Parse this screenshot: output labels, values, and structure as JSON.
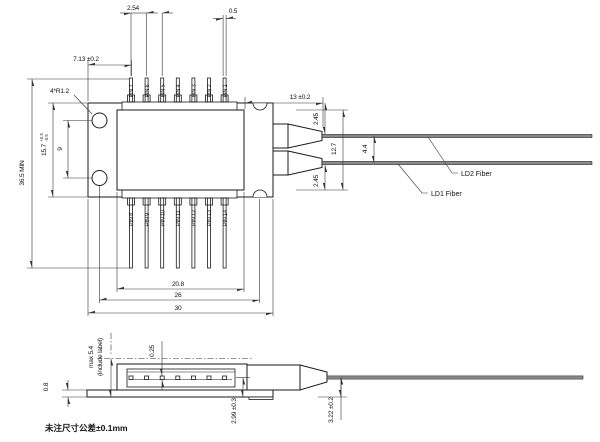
{
  "drawing": {
    "note": "未注尺寸公差±0.1mm",
    "pins_top": [
      "PIN 7",
      "PIN 6",
      "PIN 5",
      "PIN 4",
      "PIN 3",
      "PIN 2",
      "PIN 1"
    ],
    "pins_bottom": [
      "PIN 8",
      "PIN 9",
      "PIN 10",
      "PIN 11",
      "PIN 12",
      "PIN 13",
      "PIN 14"
    ],
    "fiber_labels": {
      "ld1": "LD1 Fiber",
      "ld2": "LD2 Fiber"
    },
    "dims": {
      "pin_pitch": "2.54",
      "pin_width": "0.5",
      "edge_to_pin": "7.13 ±0.2",
      "mount_radius": "4*R1.2",
      "overall_height": "36.5 MIN",
      "flange_width_value": "15.7",
      "flange_width_tol_plus": "+0.5",
      "flange_width_tol_minus": "-0.5",
      "hole_spacing": "9",
      "snout_length": "13 ±0.2",
      "fiber_offset_top": "2.45",
      "fiber_offset_bottom": "2.45",
      "fiber_span": "12.7",
      "fiber_gap": "4.4",
      "lid_width": "20.8",
      "mount_span": "26",
      "flange_length": "30",
      "pkg_height_max": "max 5.4",
      "pkg_height_note": "(include label)",
      "base_thickness": "0.8",
      "pin_thickness": "0.25",
      "fiber_axis_height": "2.99 ±0.3",
      "boot_exit_height": "3.22 ±0.2"
    },
    "colors": {
      "line": "#1a1a1a",
      "dim": "#333333",
      "fiber": "#8a8a8a",
      "background": "#ffffff"
    }
  }
}
